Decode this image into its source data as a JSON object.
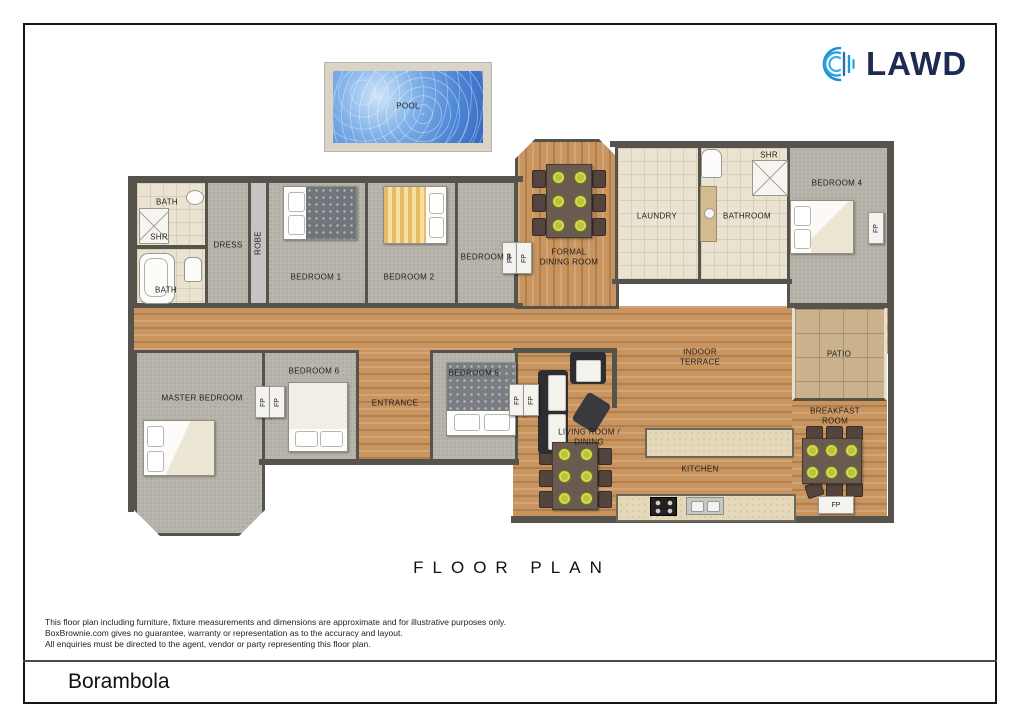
{
  "brand": {
    "name": "LAWD"
  },
  "title": "FLOOR PLAN",
  "rooms": {
    "bath1": "BATH",
    "shr1": "SHR",
    "bath2": "BATH",
    "dress": "DRESS",
    "robe": "ROBE",
    "bedroom1": "BEDROOM 1",
    "bedroom2": "BEDROOM 2",
    "bedroom3": "BEDROOM 3",
    "formal_dining": "FORMAL DINING ROOM",
    "laundry": "LAUNDRY",
    "bathroom": "BATHROOM",
    "shr2": "SHR",
    "bedroom4": "BEDROOM 4",
    "indoor_terrace": "INDOOR TERRACE",
    "patio": "PATIO",
    "master_bedroom": "MASTER BEDROOM",
    "bedroom6": "BEDROOM 6",
    "entrance": "ENTRANCE",
    "bedroom5": "BEDROOM 5",
    "living_dining": "LIVING ROOM / DINING",
    "kitchen": "KITCHEN",
    "breakfast_room": "BREAKFAST ROOM",
    "pool": "POOL",
    "fp": "FP"
  },
  "disclaimer": {
    "line1": "This floor plan including furniture, fixture measurements and dimensions are approximate and for illustrative purposes only.",
    "line2": "BoxBrownie.com gives no guarantee, warranty or representation as to the accuracy and layout.",
    "line3": "All enquiries must be directed to the agent, vendor or party representing this floor plan."
  },
  "footer": {
    "property_name": "Borambola"
  },
  "colors": {
    "wall": "#56534d",
    "wood_floor": "#c9945e",
    "carpet": "#b8b5ac",
    "tile": "#ebe3d1",
    "patio_stone": "#c9b28c",
    "pool_water": "#4d86d6",
    "plate_green": "#b9c43c",
    "brand_navy": "#1d2b50",
    "brand_blue": "#2196d4"
  }
}
